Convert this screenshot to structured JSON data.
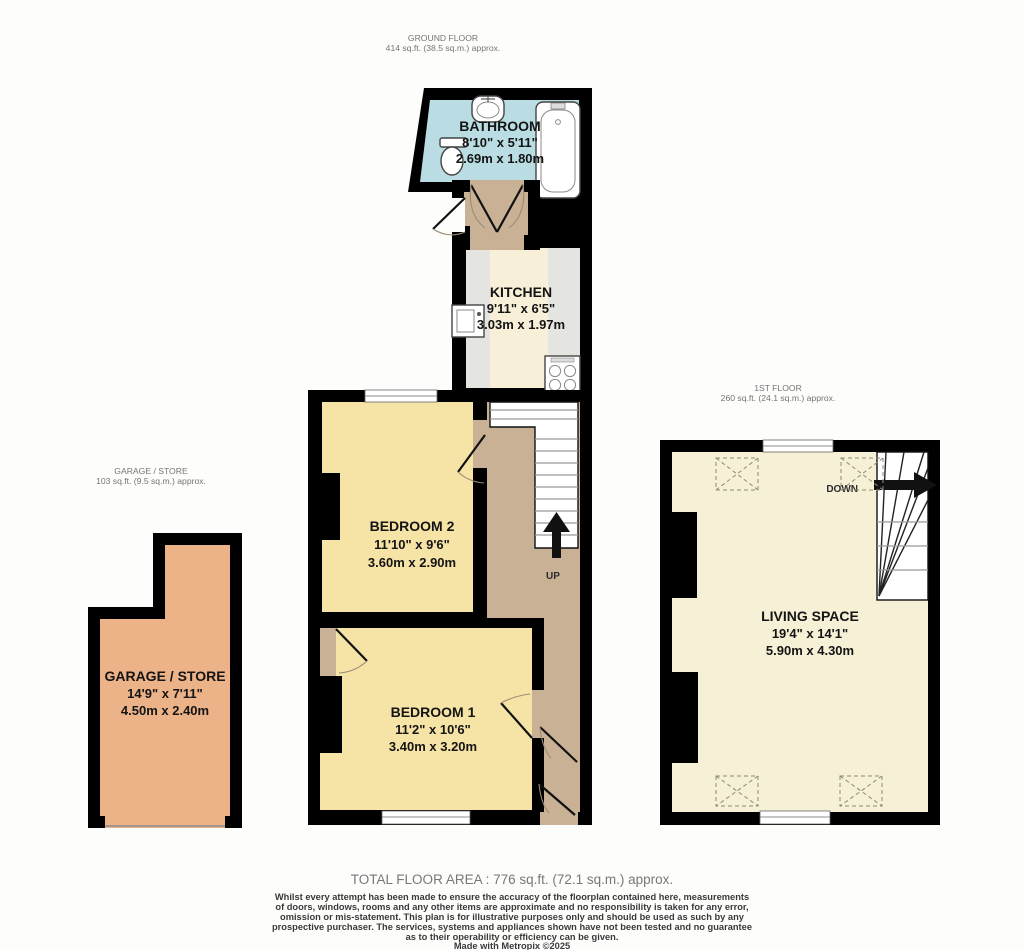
{
  "floors": {
    "ground": {
      "title": "GROUND FLOOR",
      "area": "414 sq.ft. (38.5 sq.m.) approx."
    },
    "first": {
      "title": "1ST FLOOR",
      "area": "260 sq.ft. (24.1 sq.m.) approx."
    },
    "garage": {
      "title": "GARAGE / STORE",
      "area": "103 sq.ft. (9.5 sq.m.) approx."
    }
  },
  "rooms": {
    "bathroom": {
      "name": "BATHROOM",
      "imperial": "8'10\"  x 5'11\"",
      "metric": "2.69m  x 1.80m"
    },
    "kitchen": {
      "name": "KITCHEN",
      "imperial": "9'11\"  x 6'5\"",
      "metric": "3.03m  x 1.97m"
    },
    "bedroom2": {
      "name": "BEDROOM 2",
      "imperial": "11'10\"  x 9'6\"",
      "metric": "3.60m  x 2.90m"
    },
    "bedroom1": {
      "name": "BEDROOM 1",
      "imperial": "11'2\"  x 10'6\"",
      "metric": "3.40m  x 3.20m"
    },
    "garage": {
      "name": "GARAGE / STORE",
      "imperial": "14'9\"  x 7'11\"",
      "metric": "4.50m  x 2.40m"
    },
    "living": {
      "name": "LIVING SPACE",
      "imperial": "19'4\"  x 14'1\"",
      "metric": "5.90m  x 4.30m"
    }
  },
  "stairs": {
    "up_label": "UP",
    "down_label": "DOWN"
  },
  "footer": {
    "total": "TOTAL FLOOR AREA : 776 sq.ft. (72.1 sq.m.) approx.",
    "disclaimer_lines": [
      "Whilst every attempt has been made to ensure the accuracy of the floorplan contained here, measurements",
      "of doors, windows, rooms and any other items are approximate and no responsibility is taken for any error,",
      "omission or mis-statement. This plan is for illustrative purposes only and should be used as such by any",
      "prospective purchaser. The services, systems and appliances shown have not been tested and no guarantee",
      "as to their operability or efficiency can be given."
    ],
    "credit": "Made with Metropix ©2025"
  },
  "colors": {
    "wall": "#000000",
    "bathroom": "#b9dde2",
    "kitchen": "#f7efd8",
    "bedroom": "#f6e3a6",
    "hallway": "#c8b195",
    "garage": "#ecb288",
    "living": "#f6f0d6",
    "counter": "#e4e4e0"
  }
}
